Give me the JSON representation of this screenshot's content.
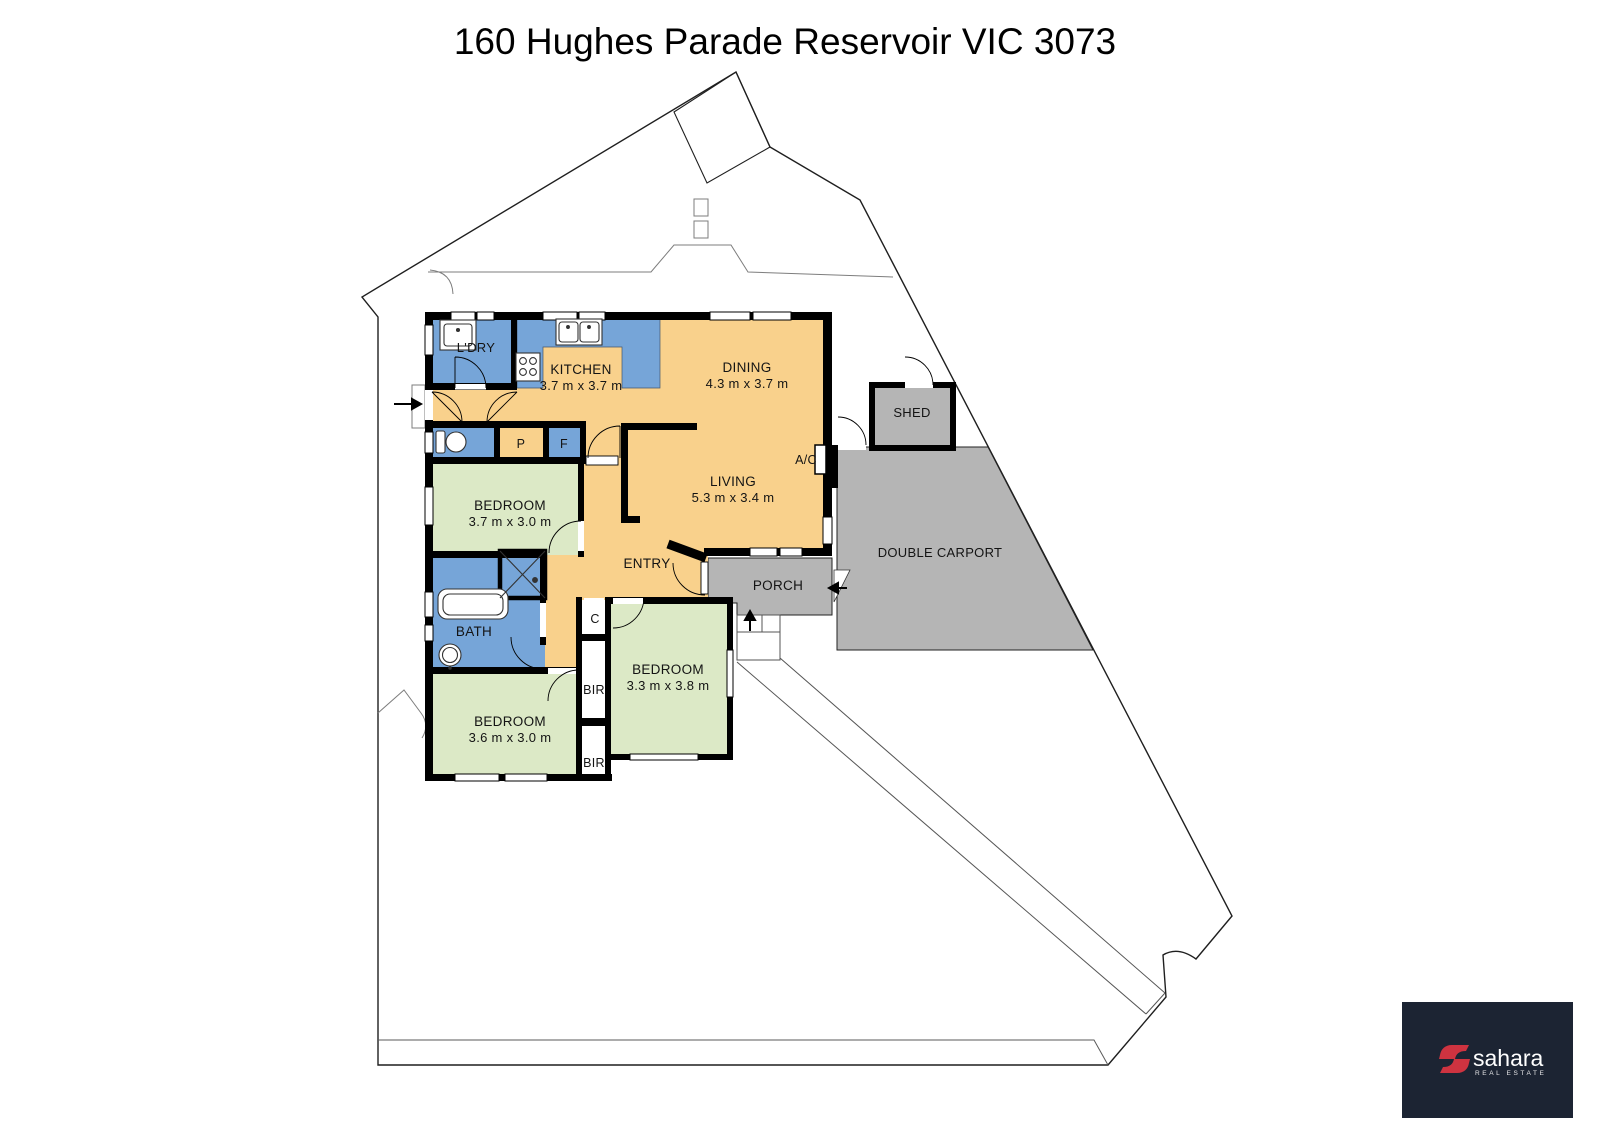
{
  "title": "160 Hughes Parade Reservoir VIC 3073",
  "colors": {
    "floor_tan": "#F9D18C",
    "wet_blue": "#76A5D8",
    "bedroom_green": "#DCE9C6",
    "outdoor_gray": "#B5B5B5",
    "wall_black": "#000000",
    "boundary_line": "#1f1f1f",
    "fence_line": "#7d7d7d",
    "logo_navy": "#1C2433",
    "logo_red": "#CE3340",
    "logo_white": "#FFFFFF"
  },
  "plan": {
    "labels": [
      {
        "id": "ldry",
        "t": "L'DRY",
        "x": 476,
        "y": 352,
        "s": 13
      },
      {
        "id": "kitchen",
        "t": "KITCHEN",
        "x": 581,
        "y": 374,
        "s": 13.5
      },
      {
        "id": "kitchen-dims",
        "t": "3.7 m x 3.7 m",
        "x": 581,
        "y": 390,
        "s": 13
      },
      {
        "id": "dining",
        "t": "DINING",
        "x": 747,
        "y": 372,
        "s": 13.5
      },
      {
        "id": "dining-dims",
        "t": "4.3 m x 3.7 m",
        "x": 747,
        "y": 388,
        "s": 13
      },
      {
        "id": "living",
        "t": "LIVING",
        "x": 733,
        "y": 486,
        "s": 13.5
      },
      {
        "id": "living-dims",
        "t": "5.3 m x 3.4 m",
        "x": 733,
        "y": 502,
        "s": 13
      },
      {
        "id": "entry",
        "t": "ENTRY",
        "x": 647,
        "y": 568,
        "s": 13.5
      },
      {
        "id": "porch",
        "t": "PORCH",
        "x": 778,
        "y": 590,
        "s": 13.5
      },
      {
        "id": "shed",
        "t": "SHED",
        "x": 912,
        "y": 417,
        "s": 13
      },
      {
        "id": "carport",
        "t": "DOUBLE CARPORT",
        "x": 940,
        "y": 557,
        "s": 13
      },
      {
        "id": "ac",
        "t": "A/C",
        "x": 806,
        "y": 464,
        "s": 12.5
      },
      {
        "id": "pantry",
        "t": "P",
        "x": 521,
        "y": 448,
        "s": 12.5
      },
      {
        "id": "fridge",
        "t": "F",
        "x": 564,
        "y": 448,
        "s": 12.5
      },
      {
        "id": "closet",
        "t": "C",
        "x": 595,
        "y": 623,
        "s": 12.5
      },
      {
        "id": "bir1",
        "t": "BIR",
        "x": 594,
        "y": 694,
        "s": 12.5
      },
      {
        "id": "bir2",
        "t": "BIR",
        "x": 594,
        "y": 767,
        "s": 12.5
      },
      {
        "id": "bath",
        "t": "BATH",
        "x": 474,
        "y": 636,
        "s": 13.5
      },
      {
        "id": "bed1",
        "t": "BEDROOM",
        "x": 510,
        "y": 510,
        "s": 13.5
      },
      {
        "id": "bed1-dims",
        "t": "3.7 m x 3.0 m",
        "x": 510,
        "y": 526,
        "s": 13
      },
      {
        "id": "bed2",
        "t": "BEDROOM",
        "x": 510,
        "y": 726,
        "s": 13.5
      },
      {
        "id": "bed2-dims",
        "t": "3.6 m x 3.0 m",
        "x": 510,
        "y": 742,
        "s": 13
      },
      {
        "id": "bed3",
        "t": "BEDROOM",
        "x": 668,
        "y": 674,
        "s": 13.5
      },
      {
        "id": "bed3-dims",
        "t": "3.3 m x 3.8 m",
        "x": 668,
        "y": 690,
        "s": 13
      }
    ]
  },
  "logo": {
    "brand": "sahara",
    "tagline": "REAL ESTATE"
  }
}
